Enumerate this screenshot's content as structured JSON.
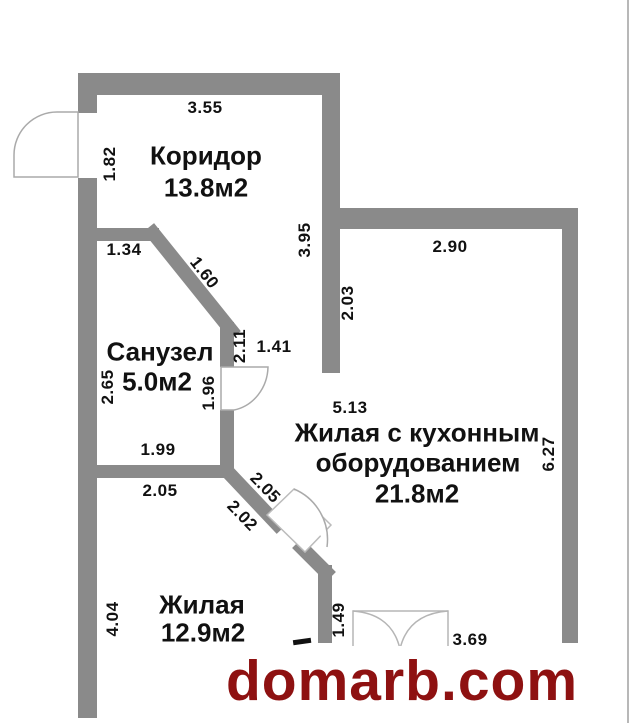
{
  "meta": {
    "type": "apartment-floor-plan"
  },
  "rooms": {
    "corridor": {
      "name": "Коридор",
      "area": "13.8м2"
    },
    "bathroom": {
      "name": "Санузел",
      "area": "5.0м2"
    },
    "living_kitchen": {
      "name_line1": "Жилая с кухонным",
      "name_line2": "оборудованием",
      "area": "21.8м2"
    },
    "living": {
      "name": "Жилая",
      "area": "12.9м2"
    }
  },
  "dimensions": {
    "corridor_top": "3.55",
    "entry_door": "1.82",
    "bathroom_top": "1.34",
    "bathroom_diagonal": "1.60",
    "corridor_right": "3.95",
    "living_kitchen_top": "2.90",
    "living_kitchen_left_upper": "2.03",
    "bathroom_wall_right": "2.11",
    "bathroom_door": "1.41",
    "bathroom_left": "2.65",
    "bathroom_right_lower": "1.96",
    "bathroom_bottom": "1.99",
    "living_top": "2.05",
    "kitchen_diagonal_upper": "2.05",
    "kitchen_diagonal_lower": "2.02",
    "living_kitchen_width": "5.13",
    "living_kitchen_right": "6.27",
    "living_left": "4.04",
    "living_right_wall": "1.49",
    "balcony_door": "3.69"
  },
  "watermark": {
    "text": "domarb.com",
    "color": "#8e1111"
  },
  "colors": {
    "wall": "#8a8a8a",
    "door_outline": "#aaaaaa",
    "label": "#111111",
    "border_line": "#b8b8b8",
    "background": "#ffffff"
  }
}
